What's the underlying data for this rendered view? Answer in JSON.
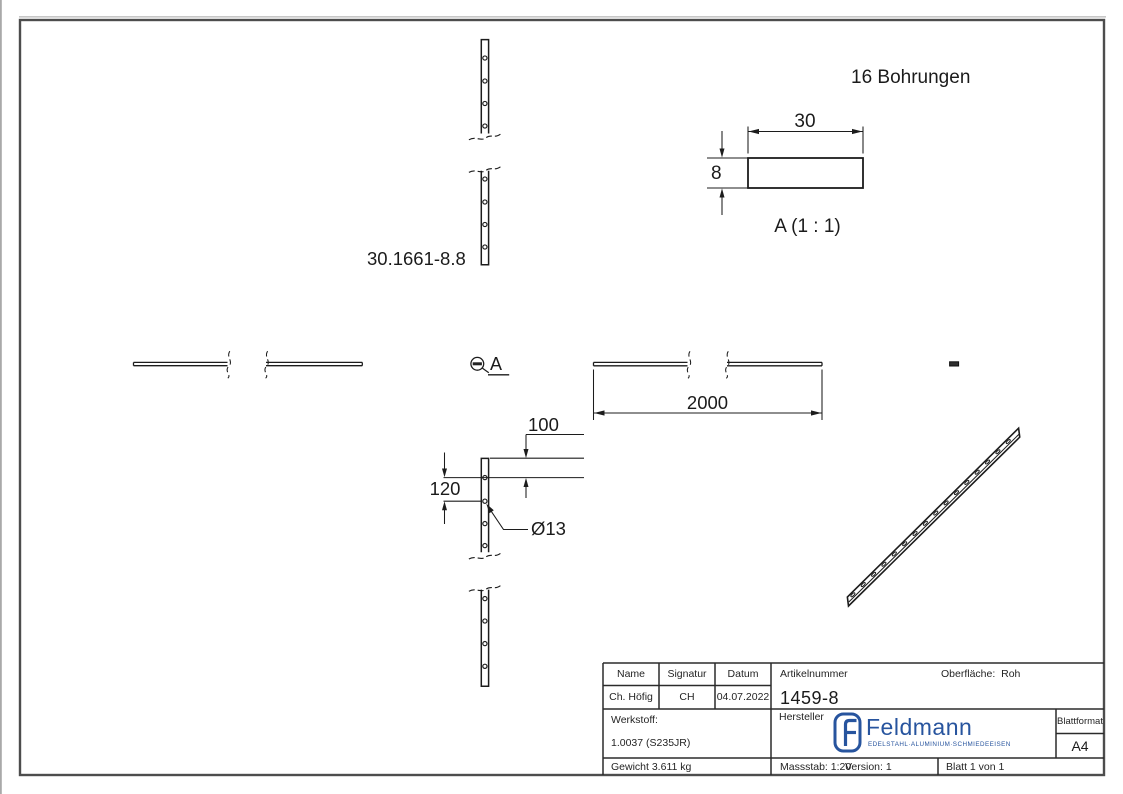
{
  "colors": {
    "line": "#1c1c1c",
    "frame": "#4d4d4d",
    "logo_blue": "#27549e"
  },
  "drawing": {
    "part_label": "30.1661-8.8",
    "note_holes": "16 Bohrungen",
    "detail": {
      "title": "A (1 : 1)",
      "callout_letter": "A",
      "dim_width": "30",
      "dim_thickness": "8"
    },
    "dims": {
      "length": "2000",
      "end_distance": "100",
      "hole_pitch": "120",
      "hole_diameter": "Ø13"
    }
  },
  "title_block": {
    "col_name": {
      "header": "Name",
      "value": "Ch. Höfig"
    },
    "col_signatur": {
      "header": "Signatur",
      "value": "CH"
    },
    "col_datum": {
      "header": "Datum",
      "value": "04.07.2022"
    },
    "artikelnummer": {
      "label": "Artikelnummer",
      "value": "1459-8"
    },
    "oberflaeche": {
      "label": "Oberfläche:",
      "value": "Roh"
    },
    "werkstoff": {
      "label": "Werkstoff:",
      "value": "1.0037 (S235JR)"
    },
    "hersteller_label": "Hersteller",
    "logo": {
      "brand": "Feldmann",
      "tagline": "EDELSTAHL·ALUMINIUM·SCHMIEDEEISEN",
      "monogram": "F"
    },
    "blattformat": {
      "label": "Blattformat",
      "value": "A4"
    },
    "gewicht": "Gewicht 3.611 kg",
    "massstab": "Massstab: 1:20",
    "version": "Version: 1",
    "blatt": "Blatt 1 von 1"
  }
}
